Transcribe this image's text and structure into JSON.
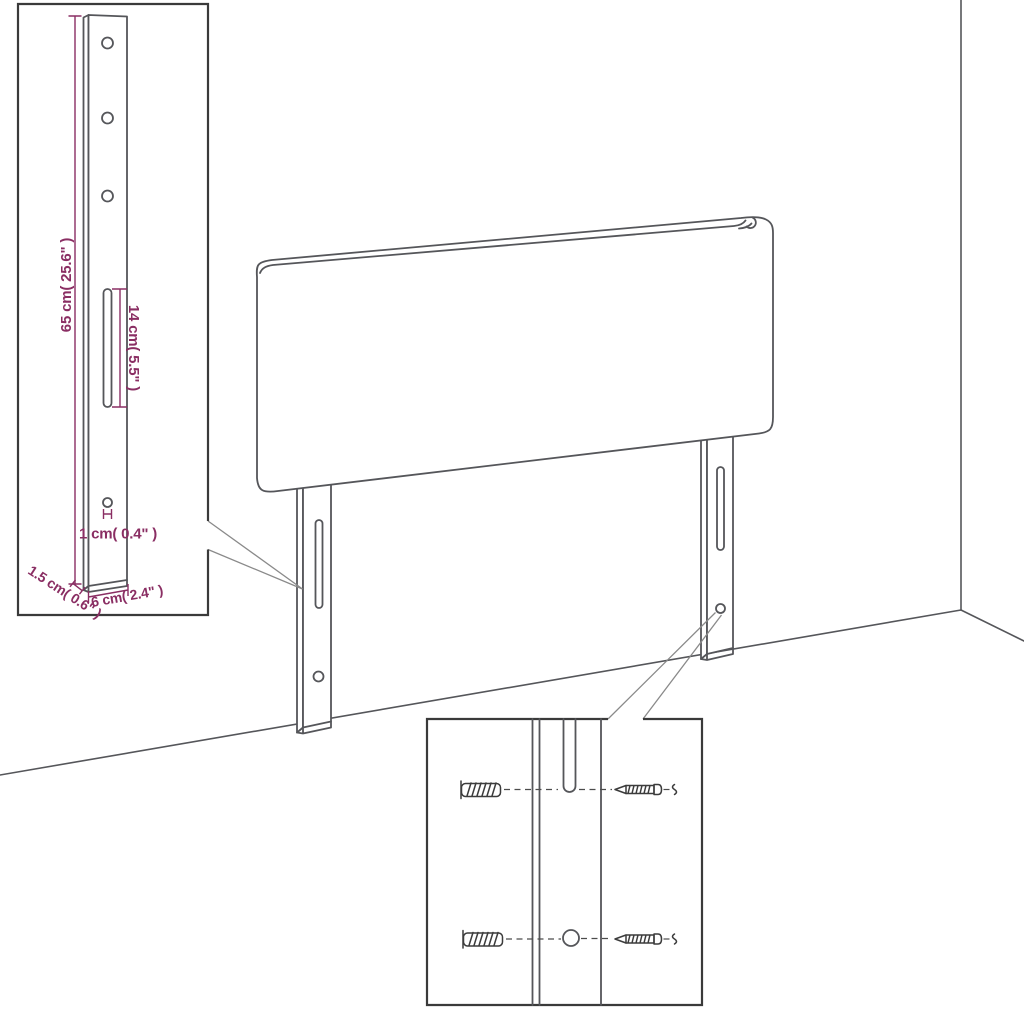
{
  "diagram": {
    "subject": "headboard-assembly-diagram",
    "colors": {
      "background": "#ffffff",
      "line": "#55565a",
      "inset_border": "#3a3a3a",
      "dimension": "#8a2e63",
      "callout": "#8a8a8a",
      "hardware": "#3c3c3c"
    },
    "dimensions": {
      "height": "65 cm( 25.6\" )",
      "slot_length": "14 cm( 5.5\" )",
      "hole": "1 cm( 0.4\" )",
      "thickness": "1.5 cm( 0.6\" )",
      "width": "6 cm( 2.4\" )"
    }
  }
}
